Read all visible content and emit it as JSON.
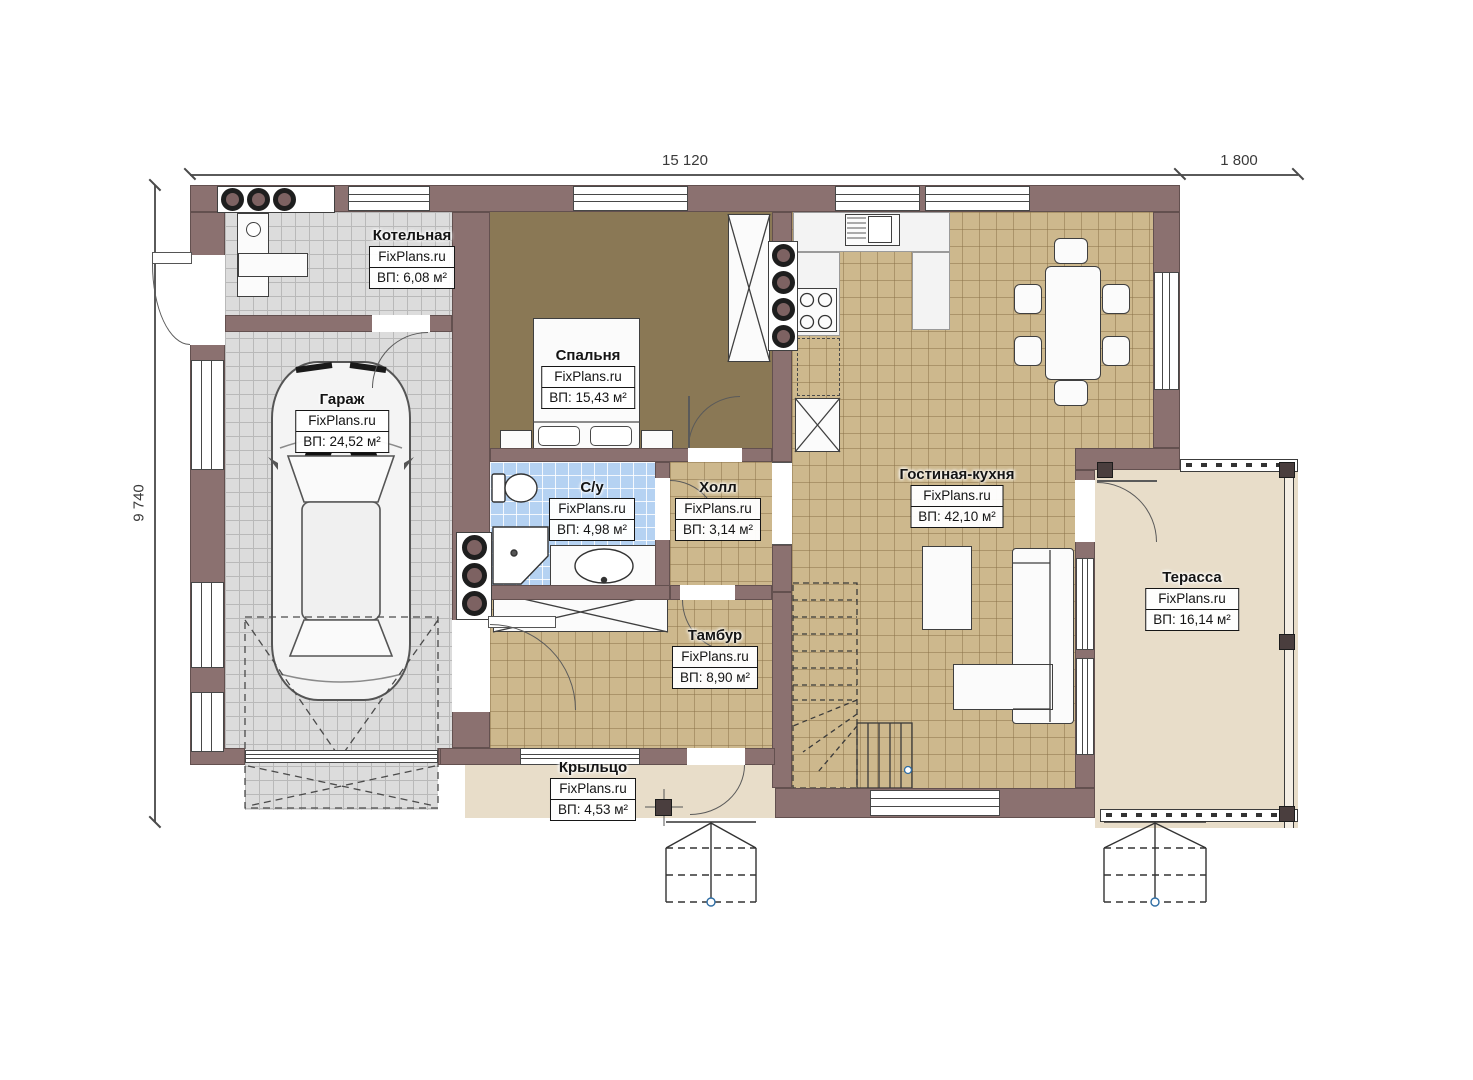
{
  "plan": {
    "watermark": "FixPlans.ru",
    "dimensions": {
      "width_main": "15 120",
      "width_terrace": "1 800",
      "height": "9 740"
    },
    "rooms": [
      {
        "name": "Котельная",
        "area": "ВП: 6,08 м²"
      },
      {
        "name": "Гараж",
        "area": "ВП: 24,52 м²"
      },
      {
        "name": "Спальня",
        "area": "ВП: 15,43 м²"
      },
      {
        "name": "С/у",
        "area": "ВП: 4,98 м²"
      },
      {
        "name": "Холл",
        "area": "ВП: 3,14 м²"
      },
      {
        "name": "Гостиная-кухня",
        "area": "ВП: 42,10 м²"
      },
      {
        "name": "Тамбур",
        "area": "ВП: 8,90 м²"
      },
      {
        "name": "Терасса",
        "area": "ВП: 16,14 м²"
      },
      {
        "name": "Крыльцо",
        "area": "ВП: 4,53 м²"
      }
    ],
    "colors": {
      "wall": "#8b7170",
      "garage_floor": "#dcdcdc",
      "bedroom_floor": "#8a7855",
      "tile_floor": "#cdb88d",
      "bath_floor": "#b5d2f2",
      "outdoor_floor": "#e8ddc9"
    }
  }
}
